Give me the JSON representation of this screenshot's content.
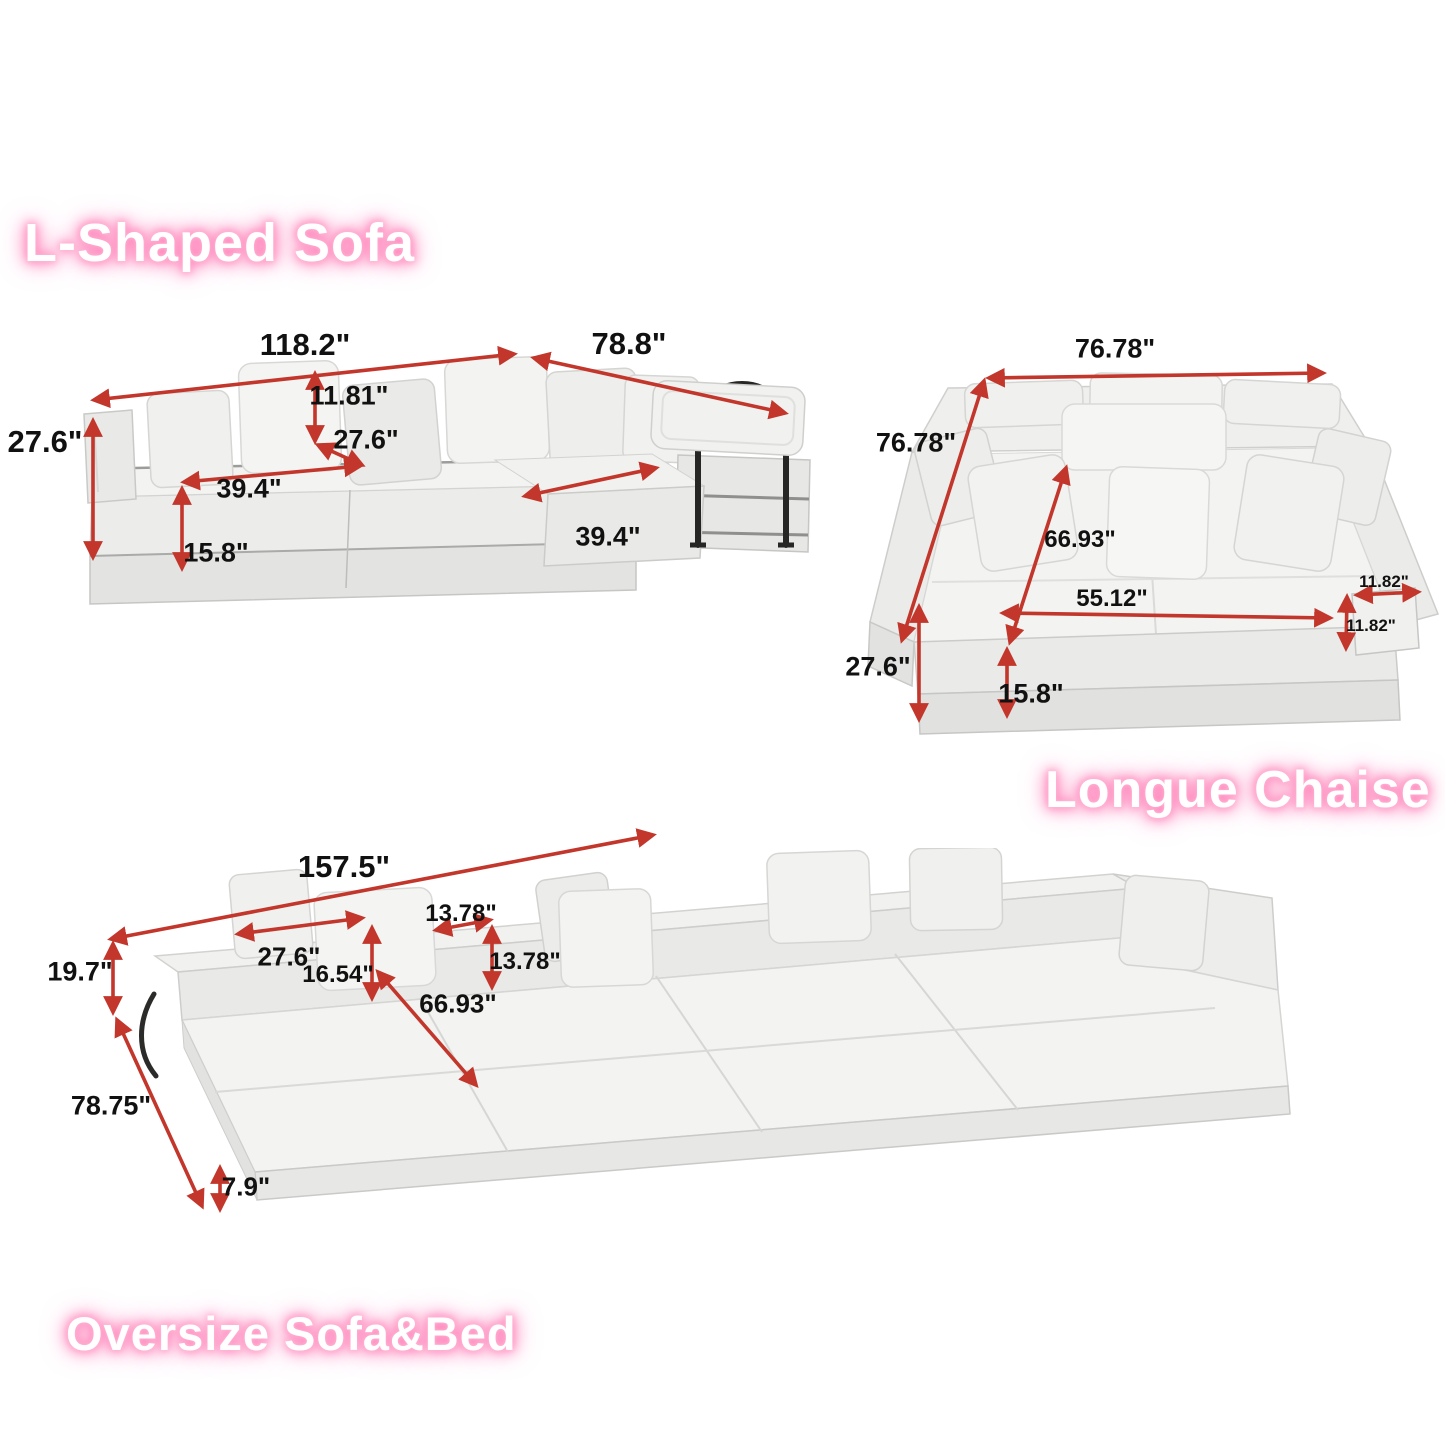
{
  "sections": {
    "l_shaped": {
      "title": "L-Shaped Sofa",
      "dims": {
        "total_width": "118.2\"",
        "chaise_length": "78.8\"",
        "overall_height": "27.6\"",
        "back_pillow_height": "11.81\"",
        "seat_depth": "27.6\"",
        "seat_width": "39.4\"",
        "chaise_seat_width": "39.4\"",
        "base_height": "15.8\""
      }
    },
    "longue_chaise": {
      "title": "Longue Chaise",
      "dims": {
        "total_width": "76.78\"",
        "total_depth": "76.78\"",
        "seat_diagonal": "66.93\"",
        "inner_width": "55.12\"",
        "armrest_width": "11.82\"",
        "armrest_height": "11.82\"",
        "overall_height": "27.6\"",
        "base_height": "15.8\""
      }
    },
    "oversize": {
      "title": "Oversize Sofa&Bed",
      "dims": {
        "total_length": "157.5\"",
        "back_height": "19.7\"",
        "total_depth": "78.75\"",
        "back_pillow_width": "27.6\"",
        "backrest_height": "16.54\"",
        "small_pillow_width": "13.78\"",
        "small_pillow_height": "13.78\"",
        "bed_diagonal": "66.93\"",
        "mattress_height": "7.9\""
      }
    }
  },
  "colors": {
    "arrow": "#c2362b",
    "label": "#111111",
    "title_text": "#ffffff",
    "title_glow": "#ff7ab5",
    "title_glow_soft": "#ffc0da",
    "fabric": "#f1f1ef"
  }
}
